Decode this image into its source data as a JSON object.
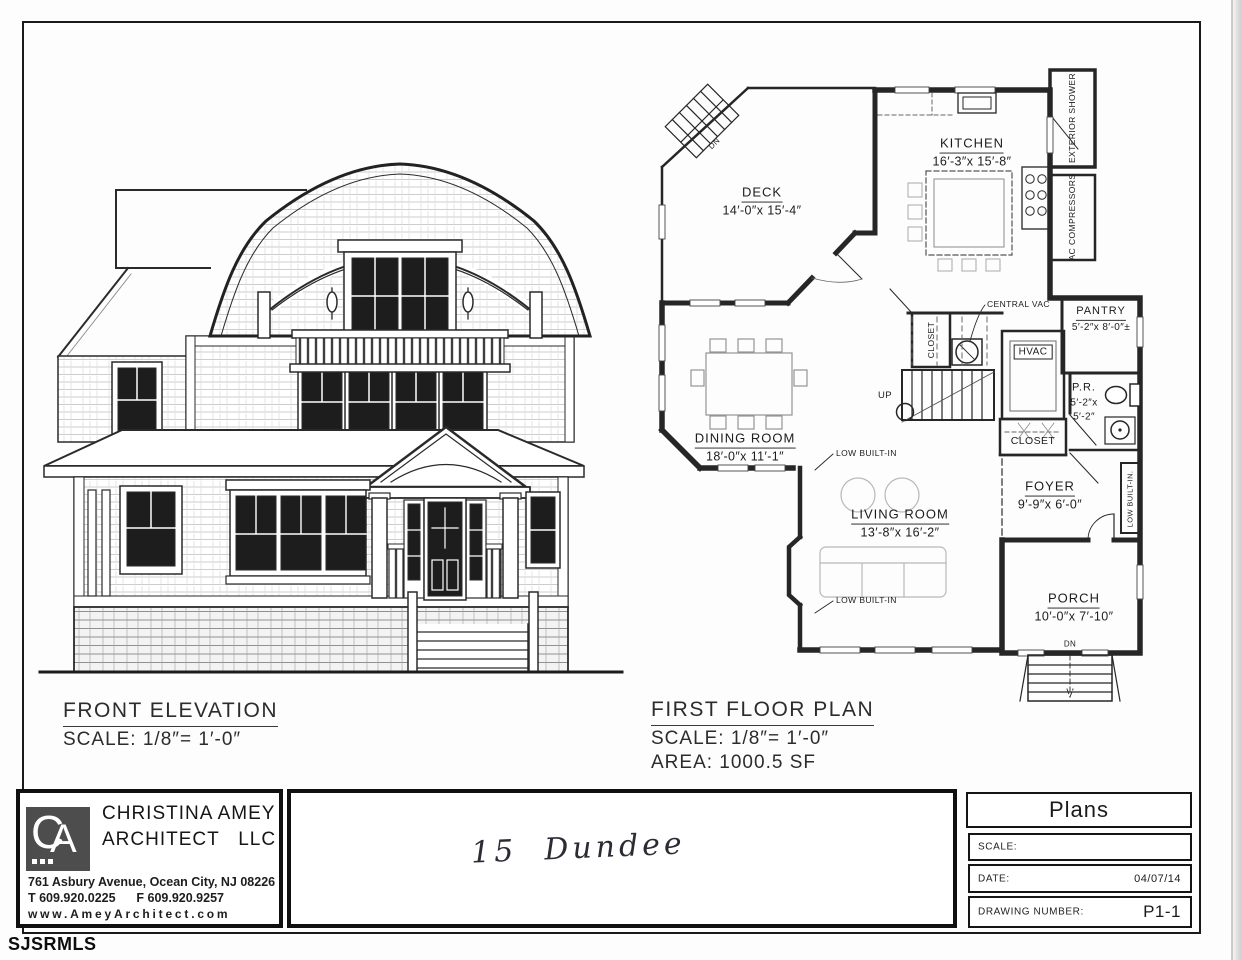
{
  "sheet": {
    "watermark": "SJSRMLS"
  },
  "front_elevation": {
    "title": "FRONT ELEVATION",
    "scale": "SCALE: 1/8″= 1′-0″"
  },
  "floor_plan": {
    "title": "FIRST FLOOR PLAN",
    "scale": "SCALE: 1/8″= 1′-0″",
    "area": "AREA: 1000.5 SF",
    "rooms": {
      "deck": {
        "name": "DECK",
        "dims": "14′-0″x 15′-4″"
      },
      "kitchen": {
        "name": "KITCHEN",
        "dims": "16′-3″x 15′-8″"
      },
      "pantry": {
        "name": "PANTRY",
        "dims": "5′-2″x 8′-0″±"
      },
      "dining": {
        "name": "DINING ROOM",
        "dims": "18′-0″x 11′-1″"
      },
      "living": {
        "name": "LIVING ROOM",
        "dims": "13′-8″x 16′-2″"
      },
      "foyer": {
        "name": "FOYER",
        "dims": "9′-9″x 6′-0″"
      },
      "porch": {
        "name": "PORCH",
        "dims": "10′-0″x 7′-10″"
      },
      "powder": {
        "name": "P.R.",
        "d1": "5′-2″x",
        "d2": "5′-2″"
      }
    },
    "labels": {
      "closet_upper": "CLOSET",
      "closet_lower": "CLOSET",
      "hvac": "HVAC",
      "central_vac": "CENTRAL VAC",
      "exterior_shower": "EXTERIOR SHOWER",
      "ac_compressors": "AC COMPRESSORS",
      "low_built_in_upper": "LOW BUILT-IN",
      "low_built_in_lower": "LOW BUILT-IN",
      "low_built_in_side": "LOW BUILT-IN.",
      "up": "UP",
      "dn_deck": "DN",
      "dn_porch": "DN"
    }
  },
  "title_block": {
    "architect": {
      "logo_c": "C",
      "logo_a": "A",
      "name_line1": "CHRISTINA AMEY",
      "name_line2": "ARCHITECT   LLC",
      "address": "761 Asbury Avenue, Ocean City, NJ 08226",
      "phone": "T 609.920.0225      F 609.920.9257",
      "website": "www.AmeyArchitect.com"
    },
    "project": {
      "handwritten": "15  Dundee"
    },
    "plans_box": {
      "title": "Plans",
      "scale_label": "SCALE:",
      "scale_value": "",
      "date_label": "DATE:",
      "date_value": "04/07/14",
      "drawing_number_label": "DRAWING NUMBER:",
      "drawing_number_value": "P1-1"
    }
  }
}
